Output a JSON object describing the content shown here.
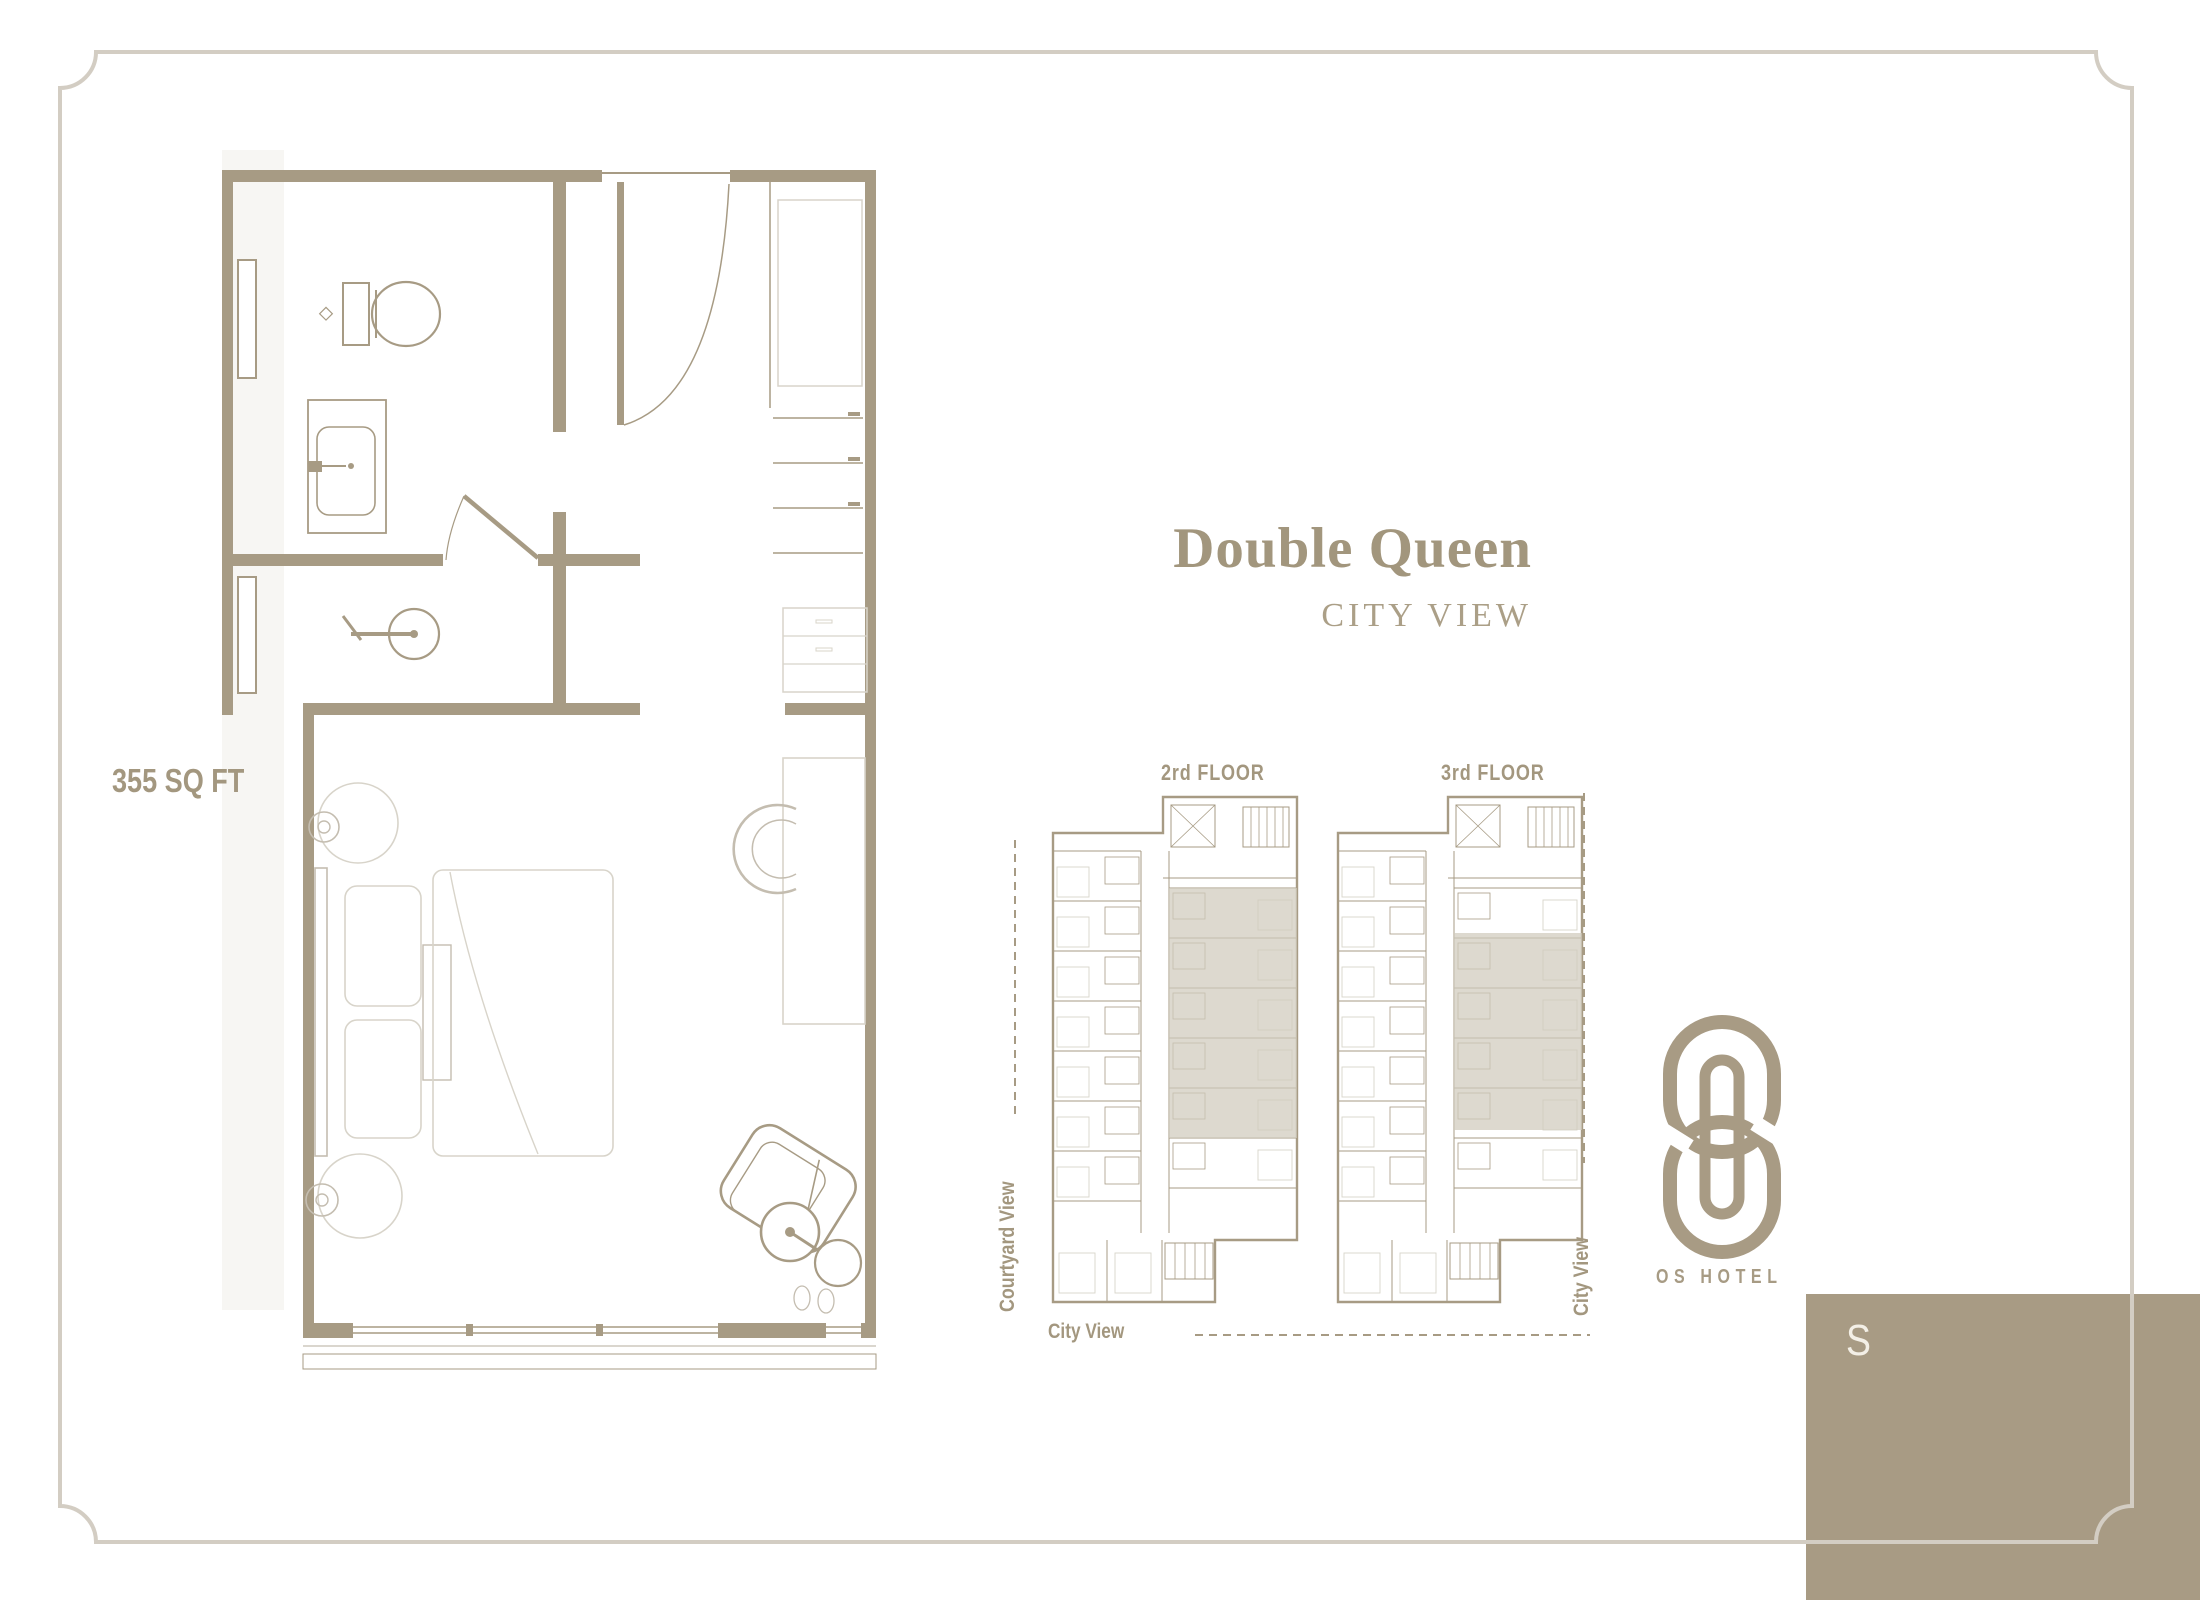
{
  "plan": {
    "area": "355 SQ FT"
  },
  "title": {
    "main": "Double Queen",
    "subtitle": "CITY VIEW"
  },
  "key_plans": {
    "floors": [
      {
        "label": "2rd FLOOR"
      },
      {
        "label": "3rd FLOOR"
      }
    ],
    "views": {
      "left": "Courtyard View",
      "bottom": "City View",
      "right": "City View"
    }
  },
  "brand": {
    "name": "OS HOTEL",
    "tab_letter": "S"
  },
  "colors": {
    "accent": "#a79b84",
    "label": "#a3977f",
    "title": "#a2967d",
    "subtitle": "#ab9f87",
    "highlight": "#d0cabd",
    "frame": "#d3cdc3",
    "furniture": "#d8d4ca",
    "mid": "#c4bdb0",
    "tab": "#a89b84",
    "tab_letter": "#f3efe6",
    "strip": "#f7f6f3"
  }
}
